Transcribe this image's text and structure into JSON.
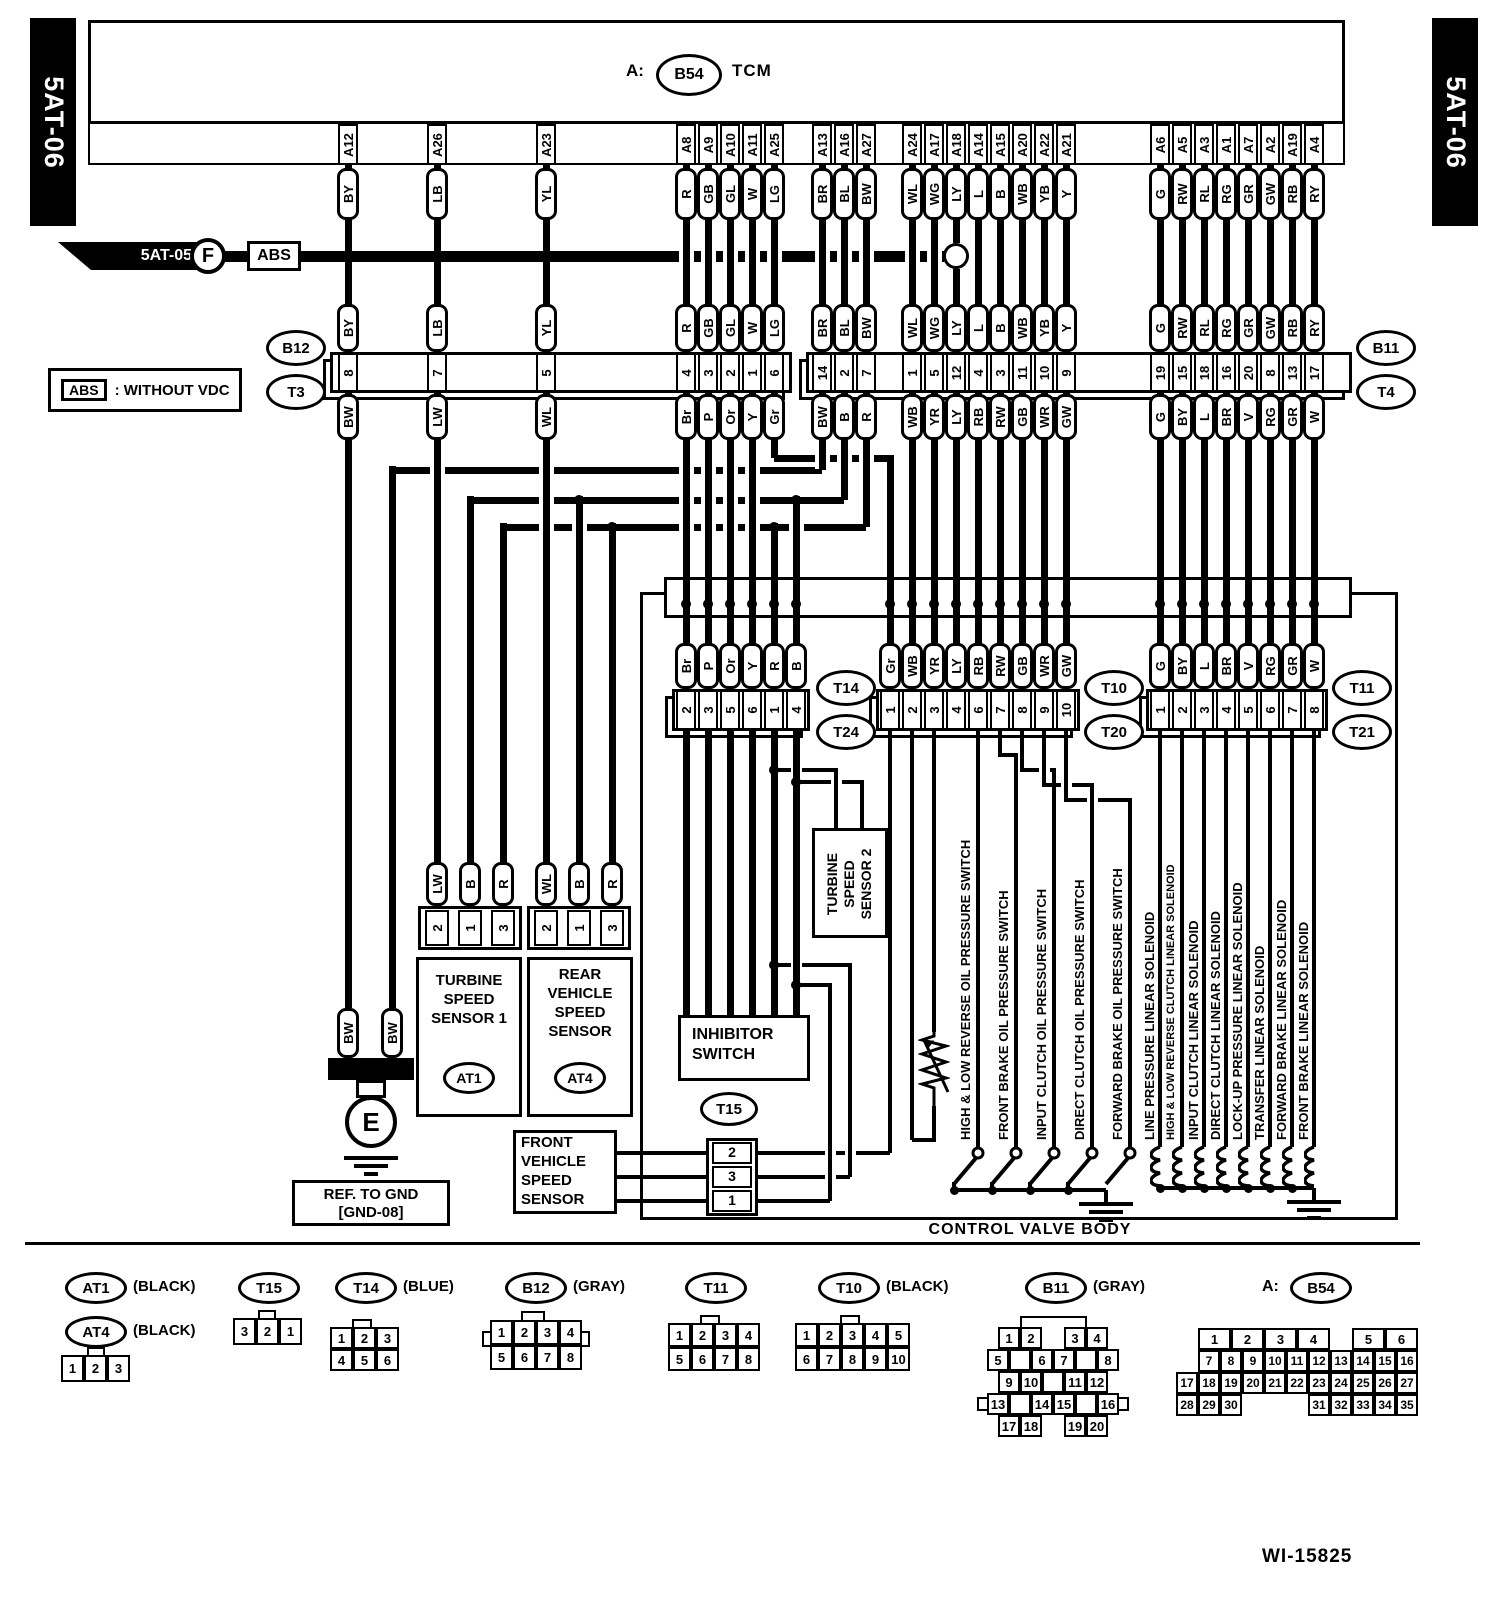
{
  "banners": {
    "left": "5AT-06",
    "right": "5AT-06"
  },
  "tcm": {
    "prefix": "A:",
    "connector": "B54",
    "label": "TCM"
  },
  "ref_tag": {
    "label": "5AT-05",
    "letter": "F",
    "target": "ABS"
  },
  "note": {
    "tag": "ABS",
    "text": ": WITHOUT VDC"
  },
  "harness": {
    "tcm_pins": [
      "A12",
      "A26",
      "A23",
      "A8",
      "A9",
      "A10",
      "A11",
      "A25",
      "A13",
      "A16",
      "A27",
      "A24",
      "A17",
      "A18",
      "A14",
      "A15",
      "A20",
      "A22",
      "A21",
      "A6",
      "A5",
      "A3",
      "A1",
      "A7",
      "A2",
      "A19",
      "A4"
    ],
    "wire_colors_top": [
      "BY",
      "LB",
      "YL",
      "R",
      "GB",
      "GL",
      "W",
      "LG",
      "BR",
      "BL",
      "BW",
      "WL",
      "WG",
      "LY",
      "L",
      "B",
      "WB",
      "YB",
      "Y",
      "G",
      "RW",
      "RL",
      "RG",
      "GR",
      "GW",
      "RB",
      "RY"
    ],
    "band_numbers": [
      "8",
      "7",
      "5",
      "4",
      "3",
      "2",
      "1",
      "6",
      "14",
      "2",
      "7",
      "1",
      "5",
      "12",
      "4",
      "3",
      "11",
      "10",
      "9",
      "19",
      "15",
      "18",
      "16",
      "20",
      "8",
      "13",
      "17"
    ],
    "wire_colors_bottom": [
      "BW",
      "LW",
      "WL",
      "Br",
      "P",
      "Or",
      "Y",
      "Gr",
      "BW",
      "B",
      "R",
      "WB",
      "YR",
      "LY",
      "RB",
      "RW",
      "GB",
      "WR",
      "GW",
      "G",
      "BY",
      "L",
      "BR",
      "V",
      "RG",
      "GR",
      "W"
    ]
  },
  "connectors_upper": {
    "left_top": "B12",
    "left_bottom": "T3",
    "right_top": "B11",
    "right_bottom": "T4"
  },
  "connectors_mid": {
    "t14": {
      "top": "T14",
      "bottom": "T24",
      "colors": [
        "Br",
        "P",
        "Or",
        "Y",
        "R",
        "B"
      ],
      "pins": [
        "2",
        "3",
        "5",
        "6",
        "1",
        "4"
      ]
    },
    "t10": {
      "top": "T10",
      "bottom": "T20",
      "colors": [
        "Gr",
        "WB",
        "YR",
        "LY",
        "RB",
        "RW",
        "GB",
        "WR",
        "GW"
      ],
      "pins": [
        "1",
        "2",
        "3",
        "4",
        "6",
        "7",
        "8",
        "9",
        "10"
      ]
    },
    "t11": {
      "top": "T11",
      "bottom": "T21",
      "colors": [
        "G",
        "BY",
        "L",
        "BR",
        "V",
        "RG",
        "GR",
        "W"
      ],
      "pins": [
        "1",
        "2",
        "3",
        "4",
        "5",
        "6",
        "7",
        "8"
      ]
    }
  },
  "devices": {
    "turbine1": {
      "lines": [
        "TURBINE",
        "SPEED",
        "SENSOR 1"
      ],
      "tag": "AT1",
      "pins": [
        "2",
        "1",
        "3"
      ],
      "colors": [
        "LW",
        "B",
        "R"
      ]
    },
    "rear_vss": {
      "lines": [
        "REAR",
        "VEHICLE",
        "SPEED",
        "SENSOR"
      ],
      "tag": "AT4",
      "pins": [
        "2",
        "1",
        "3"
      ],
      "colors": [
        "WL",
        "B",
        "R"
      ]
    },
    "front_vss": {
      "lines": [
        "FRONT",
        "VEHICLE",
        "SPEED",
        "SENSOR"
      ],
      "tag": "T15",
      "pins": [
        "2",
        "3",
        "1"
      ]
    },
    "inhibitor": {
      "lines": [
        "INHIBITOR",
        "SWITCH"
      ]
    },
    "tss2": {
      "lines": [
        "TURBINE",
        "SPEED",
        "SENSOR 2"
      ]
    },
    "atf": "ATF TEMPERATURE SENSOR",
    "ground_caps": [
      "BW",
      "BW"
    ],
    "ground_letter": "E",
    "ground_ref": [
      "REF. TO GND",
      "[GND-08]"
    ],
    "valve_body": "CONTROL VALVE BODY",
    "switches": [
      "HIGH & LOW REVERSE OIL PRESSURE SWITCH",
      "FRONT BRAKE OIL PRESSURE SWITCH",
      "INPUT CLUTCH OIL PRESSURE SWITCH",
      "DIRECT CLUTCH OIL PRESSURE SWITCH",
      "FORWARD BRAKE OIL PRESSURE SWITCH"
    ],
    "solenoids": [
      "LINE PRESSURE LINEAR SOLENOID",
      "HIGH & LOW REVERSE CLUTCH LINEAR SOLENOID",
      "INPUT CLUTCH LINEAR SOLENOID",
      "DIRECT CLUTCH LINEAR SOLENOID",
      "LOCK-UP PRESSURE LINEAR SOLENOID",
      "TRANSFER LINEAR SOLENOID",
      "FORWARD BRAKE LINEAR SOLENOID",
      "FRONT BRAKE LINEAR SOLENOID"
    ]
  },
  "legend": {
    "at1": {
      "tag": "AT1",
      "note": "(BLACK)"
    },
    "at4": {
      "tag": "AT4",
      "note": "(BLACK)",
      "rows": [
        [
          "1",
          "2",
          "3"
        ]
      ]
    },
    "t15": {
      "tag": "T15",
      "rows": [
        [
          "3",
          "2",
          "1"
        ]
      ]
    },
    "t14": {
      "tag": "T14",
      "note": "(BLUE)",
      "rows": [
        [
          "1",
          "2",
          "3"
        ],
        [
          "4",
          "5",
          "6"
        ]
      ]
    },
    "b12": {
      "tag": "B12",
      "note": "(GRAY)",
      "rows": [
        [
          "1",
          "2",
          "3",
          "4"
        ],
        [
          "5",
          "6",
          "7",
          "8"
        ]
      ]
    },
    "t11": {
      "tag": "T11",
      "rows": [
        [
          "1",
          "2",
          "3",
          "4"
        ],
        [
          "5",
          "6",
          "7",
          "8"
        ]
      ]
    },
    "t10": {
      "tag": "T10",
      "note": "(BLACK)",
      "rows": [
        [
          "1",
          "2",
          "3",
          "4",
          "5"
        ],
        [
          "6",
          "7",
          "8",
          "9",
          "10"
        ]
      ]
    },
    "b11": {
      "tag": "B11",
      "note": "(GRAY)",
      "rows": [
        [
          "1",
          "2",
          "",
          "3",
          "4"
        ],
        [
          "5",
          "x",
          "6",
          "7",
          "x",
          "8"
        ],
        [
          "9",
          "10",
          "x",
          "11",
          "12"
        ],
        [
          "13",
          "x",
          "14",
          "15",
          "x",
          "16"
        ],
        [
          "17",
          "18",
          "",
          "19",
          "20"
        ]
      ]
    },
    "b54": {
      "prefix": "A:",
      "tag": "B54",
      "rows": [
        [
          "1",
          "2",
          "3",
          "4",
          "",
          "5",
          "6"
        ],
        [
          "7",
          "8",
          "9",
          "10",
          "11",
          "12",
          "13",
          "14",
          "15",
          "16"
        ],
        [
          "17",
          "18",
          "19",
          "20",
          "21",
          "22",
          "23",
          "24",
          "25",
          "26",
          "27"
        ],
        [
          "28",
          "29",
          "30",
          "",
          "31",
          "32",
          "33",
          "34",
          "35"
        ]
      ]
    }
  },
  "doc_number": "WI-15825"
}
